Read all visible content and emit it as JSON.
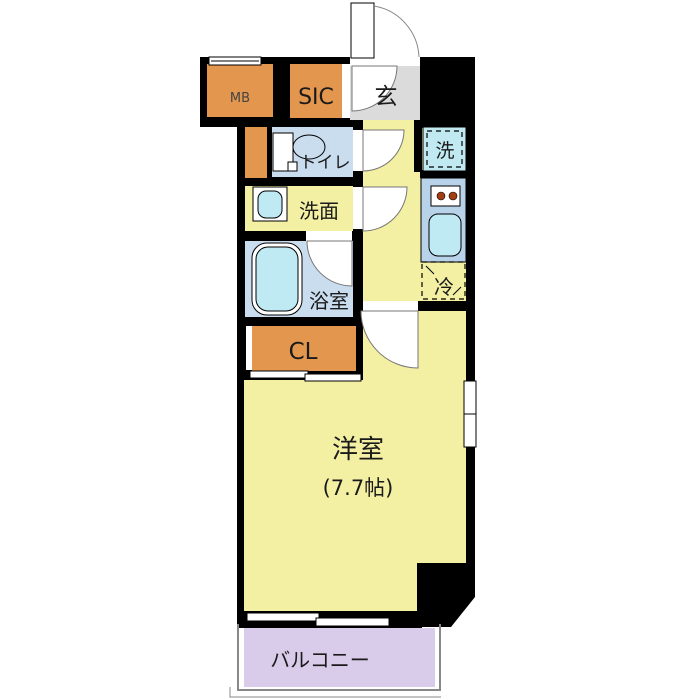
{
  "plan": {
    "type": "apartment-floor-plan",
    "rooms": {
      "mb": {
        "label": "MB"
      },
      "sic": {
        "label": "SIC"
      },
      "entrance": {
        "label": "玄"
      },
      "toilet": {
        "label": "トイレ"
      },
      "washroom": {
        "label": "洗面"
      },
      "bathroom": {
        "label": "浴室"
      },
      "closet": {
        "label": "CL"
      },
      "washer": {
        "label": "洗"
      },
      "fridge": {
        "label": "冷"
      },
      "main_room": {
        "label": "洋室",
        "size": "(7.7帖)"
      },
      "balcony": {
        "label": "バルコニー"
      }
    }
  },
  "colors": {
    "wall": "#000000",
    "floor_yellow": "#F3EFA3",
    "room_orange": "#E2964E",
    "entrance_gray": "#DBDBDB",
    "wet_floor_blue": "#CADDEF",
    "fixture_cyan": "#BFE9F3",
    "washer_cyan": "#C0E9F2",
    "counter_blue": "#B8D2EA",
    "balcony_purple": "#D9CBEA",
    "burner_brown": "#A33E12",
    "door_arc_gray": "#777777",
    "railing_gray": "#888888"
  }
}
